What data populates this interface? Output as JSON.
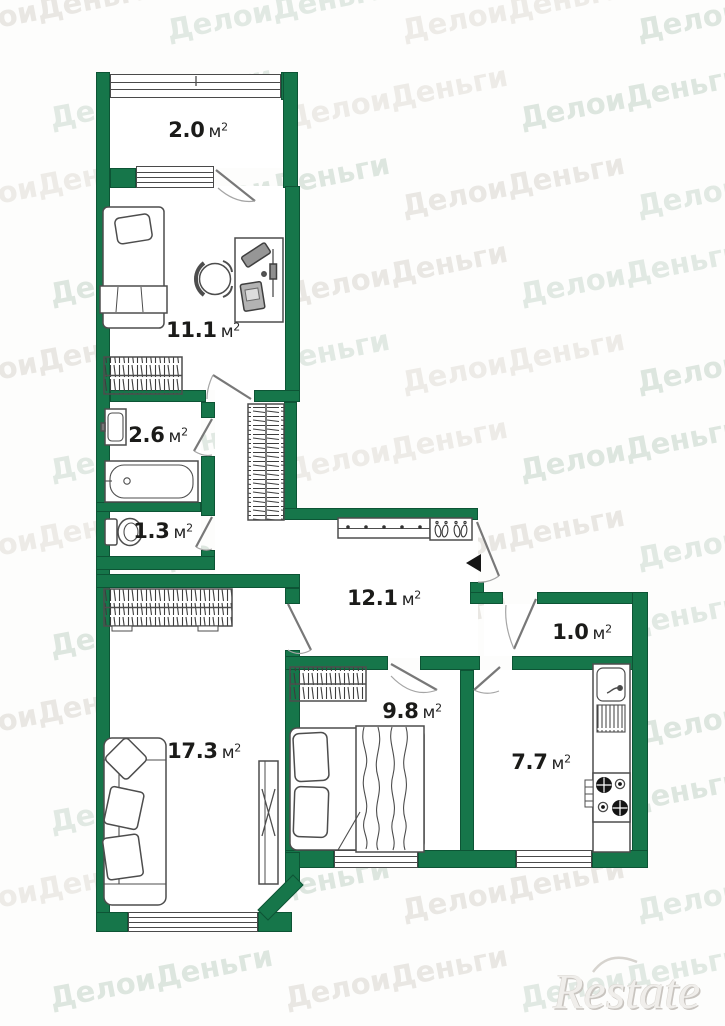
{
  "watermark": {
    "text": "ДелоиДеньги",
    "colors": [
      "#e9e7e3",
      "#e1e9e3",
      "#edebe7",
      "#dde6df"
    ],
    "rows": 12,
    "cols": 4
  },
  "logo": {
    "text": "Restate"
  },
  "plan": {
    "wall_color": "#16764a",
    "rooms": {
      "balcony": {
        "area": "2.0",
        "unit": "м",
        "exp": "2"
      },
      "child_room": {
        "area": "11.1",
        "unit": "м",
        "exp": "2"
      },
      "bathroom": {
        "area": "2.6",
        "unit": "м",
        "exp": "2"
      },
      "wc": {
        "area": "1.3",
        "unit": "м",
        "exp": "2"
      },
      "hallway": {
        "area": "12.1",
        "unit": "м",
        "exp": "2"
      },
      "storage": {
        "area": "1.0",
        "unit": "м",
        "exp": "2"
      },
      "kitchen": {
        "area": "7.7",
        "unit": "м",
        "exp": "2"
      },
      "bedroom": {
        "area": "9.8",
        "unit": "м",
        "exp": "2"
      },
      "living_room": {
        "area": "17.3",
        "unit": "м",
        "exp": "2"
      }
    }
  }
}
